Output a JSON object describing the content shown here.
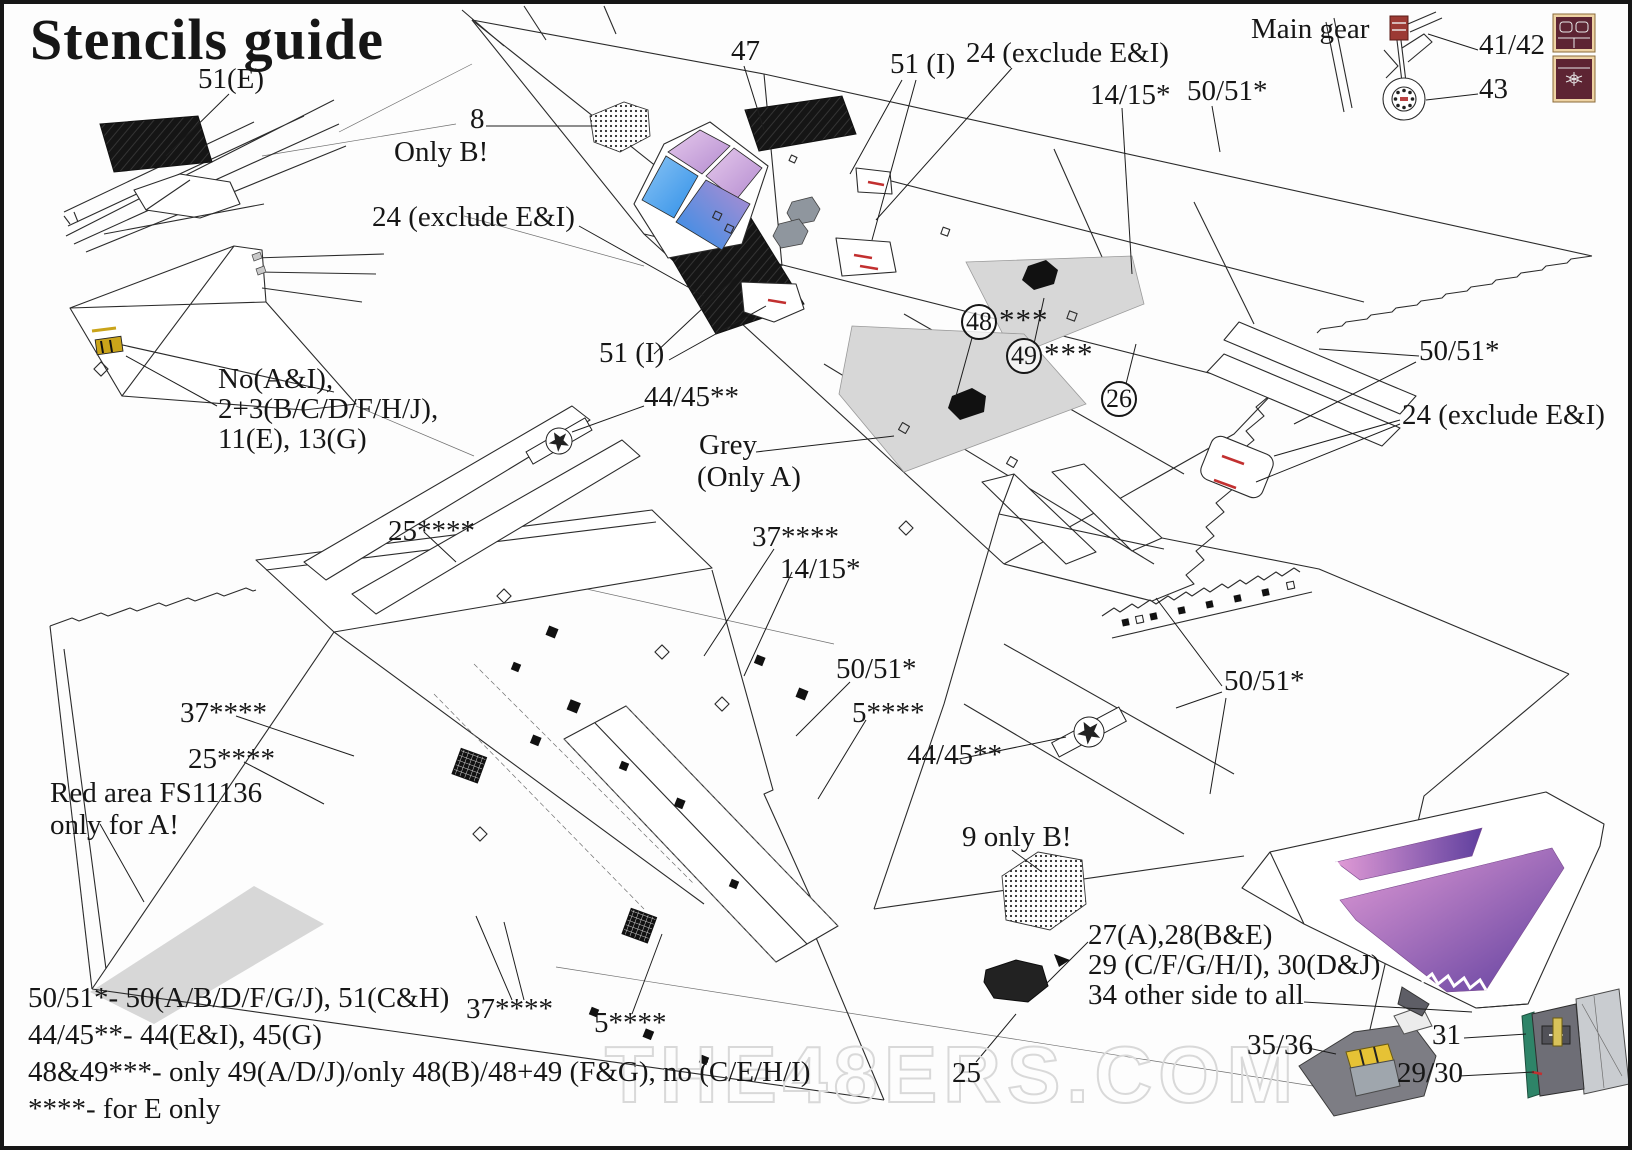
{
  "title": "Stencils guide",
  "watermark": "THE48ERS.COM",
  "colors": {
    "red_stencil": "#c23030",
    "grey_area": "#d7d7d7",
    "canopy_blue": "#2f8fe8",
    "canopy_blue2": "#8ac4f4",
    "canopy_purple": "#b48cd0",
    "canopy_pink": "#e6c9ec",
    "pink_exhaust": "#e19bd6",
    "deep_purple": "#5f3f9e",
    "maroon": "#5d2433",
    "cream": "#eed3a4",
    "yellow": "#caa41a",
    "teal": "#2e8468",
    "watermark_grey": "#d9d9d9"
  },
  "callouts": {
    "c51e": "51(E)",
    "c47": "47",
    "c51i_top": "51 (I)",
    "c24_top": "24 (exclude E&I)",
    "c1415_top": "14/15*",
    "c5051_top": "50/51*",
    "main_gear": "Main gear",
    "c4142": "41/42",
    "c43": "43",
    "c8": "8",
    "only_b": "Only B!",
    "c24_left": "24 (exclude E&I)",
    "c51i_mid": "51 (I)",
    "c4445_mid": "44/45**",
    "nose_note_1": "No(A&I),",
    "nose_note_2": "2+3(B/C/D/F/H/J),",
    "nose_note_3": "11(E), 13(G)",
    "grey_1": "Grey",
    "grey_2": "(Only A)",
    "c48": "48",
    "c48_ast": "***",
    "c49": "49",
    "c49_ast": "***",
    "c26": "26",
    "c5051_right": "50/51*",
    "c24_right": "24 (exclude E&I)",
    "c25_top": "25****",
    "c37_mid": "37****",
    "c1415_mid": "14/15*",
    "c5051_mid": "50/51*",
    "c5_mid": "5****",
    "c4445_right": "44/45**",
    "c5051_far": "50/51*",
    "c37_left": "37****",
    "c25_left": "25****",
    "red_area_1": "Red area FS11136",
    "red_area_2": "only for A!",
    "c9_only_b": "9 only B!",
    "side_note_1": "27(A),28(B&E)",
    "side_note_2": "29 (C/F/G/H/I), 30(D&J)",
    "side_note_3": "34 other side to all",
    "c3536": "35/36",
    "c31": "31",
    "c2930": "29/30",
    "c37_bot": "37****",
    "c5_bot": "5****",
    "c25_bot": "25"
  },
  "legend": [
    "50/51*- 50(A/B/D/F/G/J), 51(C&H)",
    "44/45**- 44(E&I), 45(G)",
    "48&49***- only 49(A/D/J)/only 48(B)/48+49 (F&G), no (C/E/H/I)",
    "****- for E only"
  ]
}
